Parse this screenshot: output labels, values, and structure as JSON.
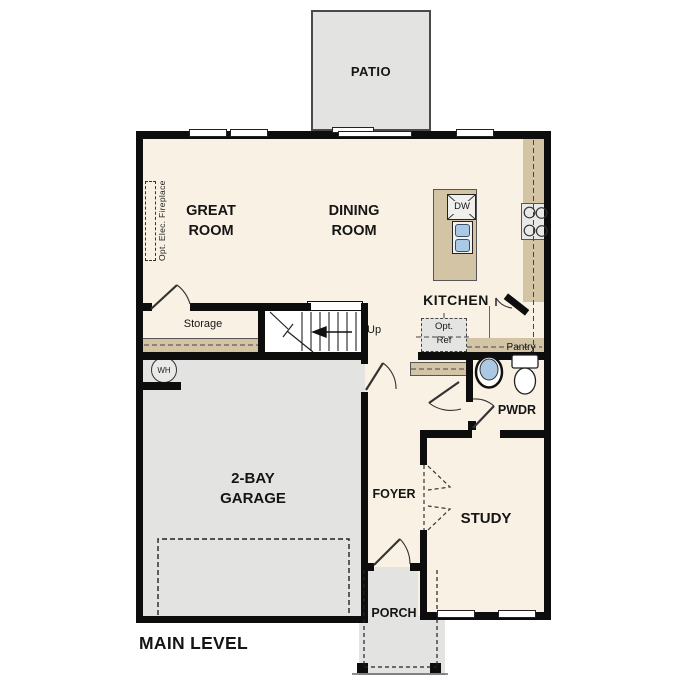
{
  "plan": {
    "title": "MAIN LEVEL",
    "rooms": {
      "patio": "PATIO",
      "great_room": "GREAT\nROOM",
      "dining_room": "DINING\nROOM",
      "kitchen": "KITCHEN",
      "storage": "Storage",
      "garage": "2-BAY\nGARAGE",
      "foyer": "FOYER",
      "study": "STUDY",
      "powder": "PWDR",
      "porch": "PORCH",
      "pantry": "Pantry"
    },
    "annotations": {
      "up": "Up",
      "dishwasher": "DW",
      "water_heater": "WH",
      "opt_ref": "Opt.\nRef",
      "opt_elec_fireplace": "Opt. Elec. Fireplace"
    },
    "colors": {
      "floor": "#f8f1e4",
      "exterior_concrete": "#e3e3e1",
      "counter": "#d3c4a6",
      "wall": "#0d0d0d",
      "fixture_blue": "#abc8e4"
    }
  }
}
